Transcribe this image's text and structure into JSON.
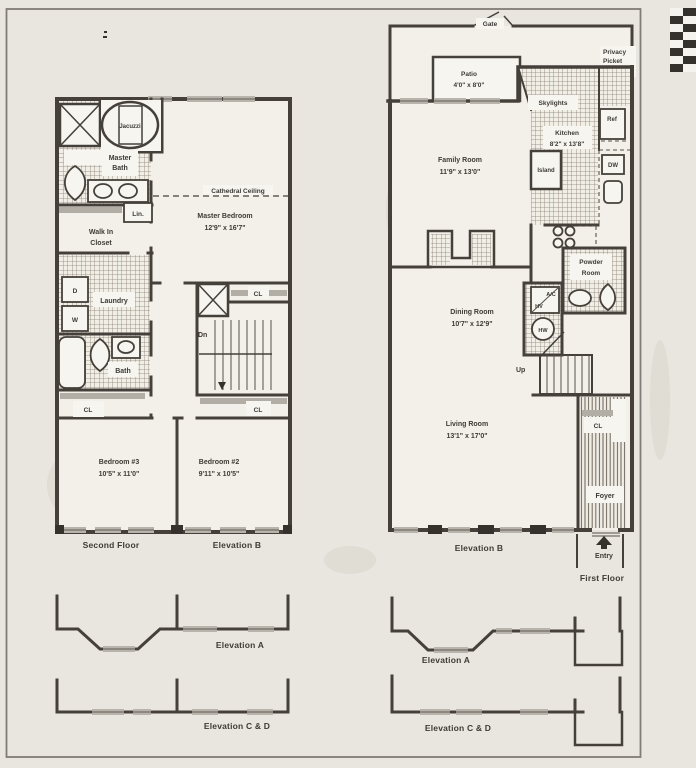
{
  "colors": {
    "paper": "#e9e6df",
    "ink": "#3e3a35",
    "wall": "#45403a",
    "window_gray": "#b9b4ab"
  },
  "second_floor": {
    "title": "Second Floor",
    "elevation": "Elevation B",
    "jacuzzi": "Jacuzzi",
    "master_bath_1": "Master",
    "master_bath_2": "Bath",
    "cathedral": "Cathedral Ceiling",
    "linen": "Lin.",
    "wic_1": "Walk In",
    "wic_2": "Closet",
    "master_bedroom": "Master Bedroom",
    "master_bedroom_dim": "12'9\" x 16'7\"",
    "dryer": "D",
    "washer": "W",
    "laundry": "Laundry",
    "bath": "Bath",
    "cl_hall": "CL",
    "cl_chase": "CL",
    "cl_bed": "CL",
    "down": "Dn",
    "bedroom3": "Bedroom #3",
    "bedroom3_dim": "10'5\" x 11'0\"",
    "bedroom2": "Bedroom #2",
    "bedroom2_dim": "9'11\" x 10'5\""
  },
  "first_floor": {
    "title": "First Floor",
    "elevation": "Elevation B",
    "gate": "Gate",
    "fence_1": "Privacy",
    "fence_2": "Picket",
    "fence_3": "Fence",
    "patio": "Patio",
    "patio_dim": "4'0\" x 8'0\"",
    "skylights": "Skylights",
    "ref": "Ref",
    "kitchen": "Kitchen",
    "kitchen_dim": "8'2\" x 13'8\"",
    "island": "Island",
    "dw": "DW",
    "family_room": "Family Room",
    "family_room_dim": "11'9\" x 13'0\"",
    "powder_1": "Powder",
    "powder_2": "Room",
    "ac": "A/C",
    "hv": "HV",
    "hw": "HW",
    "up": "Up",
    "dining_room": "Dining Room",
    "dining_room_dim": "10'7\" x 12'9\"",
    "living_room": "Living Room",
    "living_room_dim": "13'1\" x 17'0\"",
    "cl": "CL",
    "foyer": "Foyer",
    "entry": "Entry"
  },
  "elevations": {
    "left_a": "Elevation A",
    "left_cd": "Elevation C & D",
    "right_a": "Elevation A",
    "right_cd": "Elevation C & D"
  }
}
